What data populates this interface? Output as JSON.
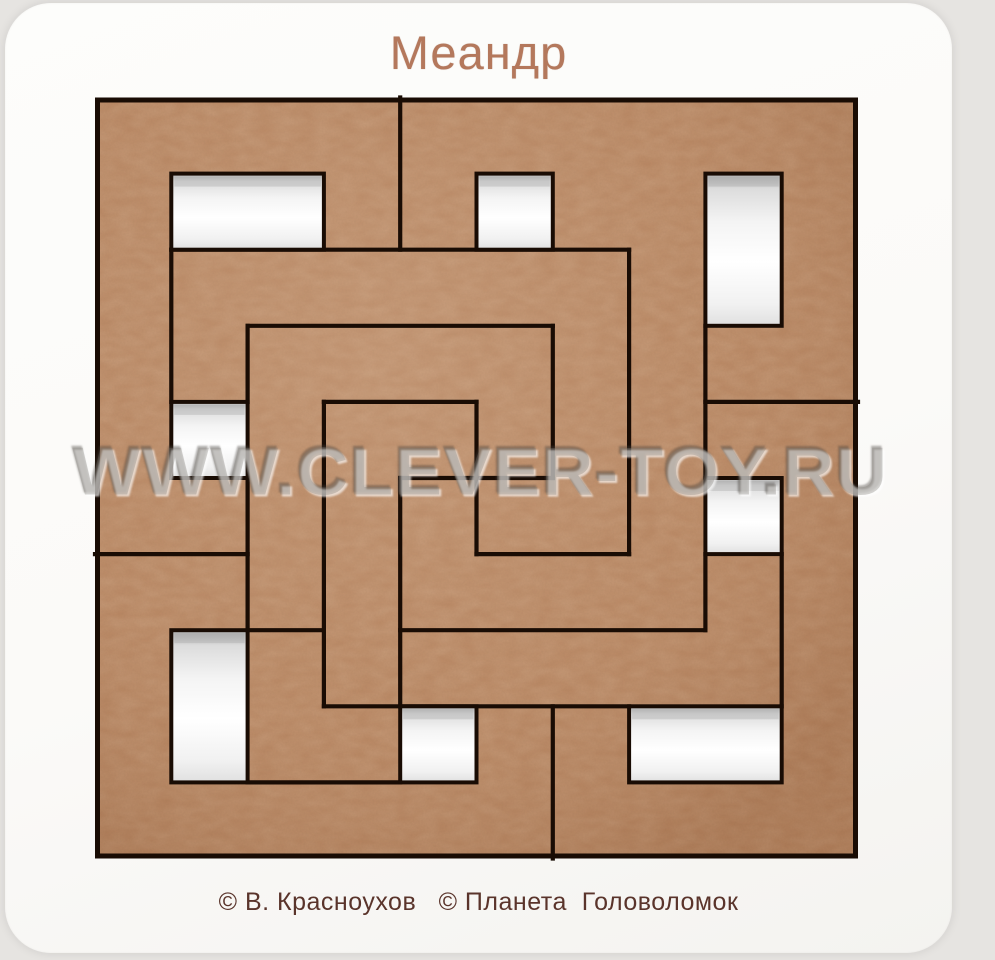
{
  "board": {
    "title": "Меандр",
    "watermark": "WWW.CLEVER-TOY.RU",
    "credits": "© В. Красноухов   © Планета  Головоломок"
  },
  "colors": {
    "page_bg": "#e6e4e1",
    "board_bg": "#fbfaf8",
    "wood": "#b5815c",
    "wood_speckle_dark": "#4d2914",
    "wood_speckle_light": "#d9a87b",
    "cut_line": "#190c04",
    "hole_white": "#ffffff",
    "hole_shade": "#b9b9b9",
    "title_color": "#b4785c",
    "credits_color": "#5a342b",
    "watermark_color": "#807c77"
  },
  "puzzle": {
    "grid": {
      "cols": 10,
      "rows": 10,
      "x": 95,
      "y": 97,
      "cell_w": 76.3,
      "cell_h": 76.1
    },
    "holes": [
      {
        "c": 1,
        "r": 1,
        "w": 2,
        "h": 1
      },
      {
        "c": 5,
        "r": 1,
        "w": 1,
        "h": 1
      },
      {
        "c": 8,
        "r": 1,
        "w": 1,
        "h": 2
      },
      {
        "c": 1,
        "r": 4,
        "w": 1,
        "h": 1
      },
      {
        "c": 8,
        "r": 5,
        "w": 1,
        "h": 1
      },
      {
        "c": 1,
        "r": 7,
        "w": 1,
        "h": 2
      },
      {
        "c": 4,
        "r": 8,
        "w": 1,
        "h": 1
      },
      {
        "c": 7,
        "r": 8,
        "w": 2,
        "h": 1
      }
    ],
    "cuts": [
      {
        "x1": 4,
        "y1": 0,
        "x2": 4,
        "y2": 2
      },
      {
        "x1": 1,
        "y1": 2,
        "x2": 7,
        "y2": 2
      },
      {
        "x1": 7,
        "y1": 2,
        "x2": 7,
        "y2": 6
      },
      {
        "x1": 5,
        "y1": 6,
        "x2": 7,
        "y2": 6
      },
      {
        "x1": 5,
        "y1": 4,
        "x2": 5,
        "y2": 6
      },
      {
        "x1": 3,
        "y1": 4,
        "x2": 5,
        "y2": 4
      },
      {
        "x1": 4,
        "y1": 5,
        "x2": 6,
        "y2": 5
      },
      {
        "x1": 6,
        "y1": 3,
        "x2": 6,
        "y2": 5
      },
      {
        "x1": 2,
        "y1": 3,
        "x2": 6,
        "y2": 3
      },
      {
        "x1": 2,
        "y1": 3,
        "x2": 2,
        "y2": 4
      },
      {
        "x1": 1,
        "y1": 2,
        "x2": 1,
        "y2": 4
      },
      {
        "x1": 2,
        "y1": 5,
        "x2": 2,
        "y2": 7
      },
      {
        "x1": 0,
        "y1": 6,
        "x2": 2,
        "y2": 6
      },
      {
        "x1": 3,
        "y1": 4,
        "x2": 3,
        "y2": 8
      },
      {
        "x1": 4,
        "y1": 5,
        "x2": 4,
        "y2": 8
      },
      {
        "x1": 2,
        "y1": 7,
        "x2": 3,
        "y2": 7
      },
      {
        "x1": 4,
        "y1": 7,
        "x2": 8,
        "y2": 7
      },
      {
        "x1": 8,
        "y1": 3,
        "x2": 8,
        "y2": 5
      },
      {
        "x1": 8,
        "y1": 6,
        "x2": 8,
        "y2": 7
      },
      {
        "x1": 9,
        "y1": 6,
        "x2": 9,
        "y2": 8
      },
      {
        "x1": 8,
        "y1": 4,
        "x2": 10,
        "y2": 4
      },
      {
        "x1": 3,
        "y1": 8,
        "x2": 7,
        "y2": 8
      },
      {
        "x1": 2,
        "y1": 9,
        "x2": 4,
        "y2": 9
      },
      {
        "x1": 6,
        "y1": 8,
        "x2": 6,
        "y2": 10
      }
    ]
  }
}
